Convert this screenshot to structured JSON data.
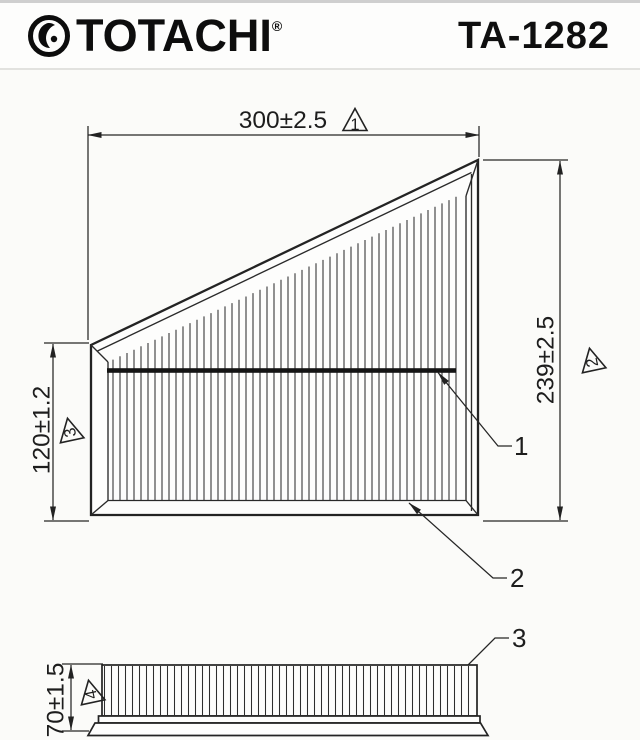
{
  "header": {
    "brand": "TOTACHI",
    "registered": "®",
    "part_number": "TA-1282"
  },
  "drawing": {
    "dim_width": {
      "value": "300±2.5",
      "marker": "1"
    },
    "dim_height": {
      "value": "239±2.5",
      "marker": "2"
    },
    "dim_left_height": {
      "value": "120±1.2",
      "marker": "3"
    },
    "dim_depth": {
      "value": "70±1.5",
      "marker": "4"
    },
    "callout_support_rib": "1",
    "callout_frame": "2",
    "callout_pleats": "3"
  }
}
